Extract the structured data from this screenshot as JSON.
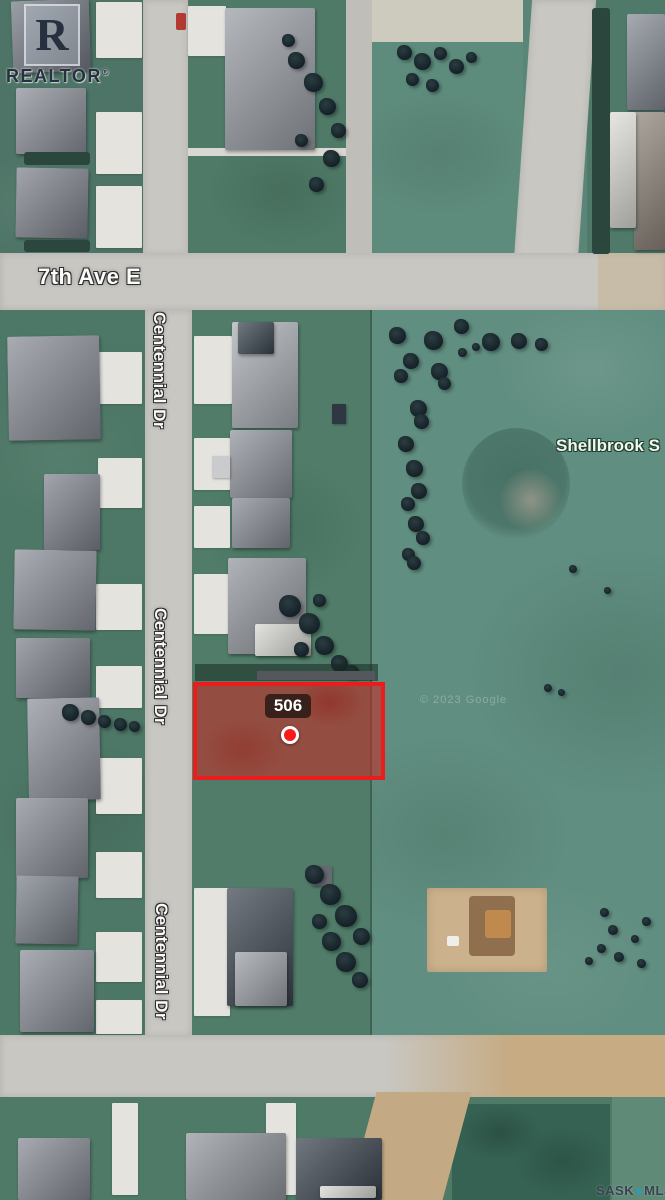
{
  "watermarks": {
    "realtor": {
      "letter": "R",
      "name": "REALTOR",
      "reg": "®"
    },
    "brand": {
      "sask": "SASK",
      "mls": "MLS",
      "reg": "®"
    },
    "google": "© 2023 Google"
  },
  "labels": {
    "ave7": "7th Ave E",
    "centennial": "Centennial Dr",
    "shellbrook": "Shellbrook S"
  },
  "parcel": {
    "number": "506"
  },
  "colors": {
    "parcel_border": "#ec1c1c",
    "parcel_fill": "rgba(204,38,32,0.55)",
    "marker_red": "#fb1a1a",
    "field_green": "#608e80",
    "road_grey": "#c8c7c2",
    "dirt_tan": "#c6ab83",
    "mls_dot_teal": "#2e9bb5"
  }
}
